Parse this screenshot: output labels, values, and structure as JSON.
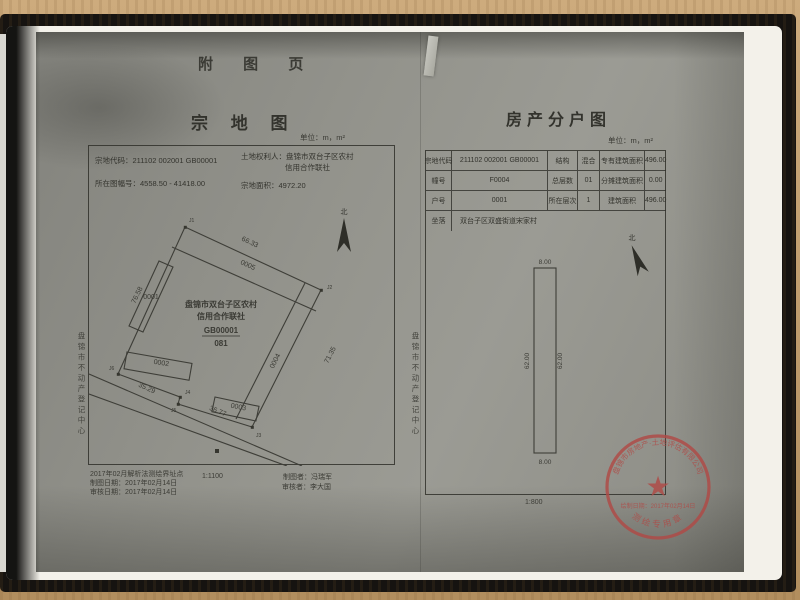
{
  "page": {
    "header": "附 图 页"
  },
  "parcel_map": {
    "title": "宗 地 图",
    "unit": "单位：m，m²",
    "info": {
      "code_label": "宗地代码：",
      "code": "211102 002001 GB00001",
      "holder_label": "土地权利人：",
      "holder_line1": "盘锦市双台子区农村",
      "holder_line2": "信用合作联社",
      "sheet_label": "所在图幅号：",
      "sheet": "4558.50 - 41418.00",
      "area_label": "宗地面积：",
      "area": "4972.20"
    },
    "drawing": {
      "north": "北",
      "owner_line1": "盘锦市双台子区农村",
      "owner_line2": "信用合作联社",
      "parcel_code": "GB00001",
      "parcel_sub": "081",
      "buildings": [
        "0001",
        "0002",
        "0003",
        "0004",
        "0005"
      ],
      "edge_top": "66.33",
      "edge_left": "76.58",
      "edge_right": "71.35",
      "edge_bottom1": "35.29",
      "edge_bottom2": "36.77",
      "corners": [
        "J1",
        "J2",
        "J3",
        "J4",
        "J5",
        "J6"
      ]
    },
    "footer": {
      "note": "2017年02月解析法测绘界址点",
      "draw_date": "制图日期：2017年02月14日",
      "review_date": "审核日期：2017年02月14日",
      "scale": "1:1100",
      "drafter": "制图者：冯瑞军",
      "reviewer": "审核者：李大国"
    },
    "side_text": "盘锦市不动产登记中心"
  },
  "household_map": {
    "title": "房产分户图",
    "unit": "单位：m，m²",
    "table": {
      "rows": [
        {
          "c1": "宗地代码",
          "v1": "211102 002001 GB00001",
          "c2": "结构",
          "v2": "混合",
          "c3": "专有建筑面积",
          "v3": "496.00"
        },
        {
          "c1": "幢号",
          "v1": "F0004",
          "c2": "总层数",
          "v2": "01",
          "c3": "分摊建筑面积",
          "v3": "0.00"
        },
        {
          "c1": "户号",
          "v1": "0001",
          "c2": "所在层次",
          "v2": "1",
          "c3": "建筑面积",
          "v3": "496.00"
        },
        {
          "c1": "坐落",
          "v1": "双台子区双盛街道宋家村"
        }
      ]
    },
    "drawing": {
      "north": "北",
      "dim_top": "8.00",
      "dim_left": "62.00",
      "dim_right": "62.00",
      "dim_bottom": "8.00"
    },
    "scale": "1:800",
    "seal": {
      "arc": "盘锦市房地产·土地评估有限公司",
      "date": "绘制日期：2017年02月14日",
      "bottom": "测绘专用章"
    },
    "side_text": "盘锦市不动产登记中心"
  }
}
